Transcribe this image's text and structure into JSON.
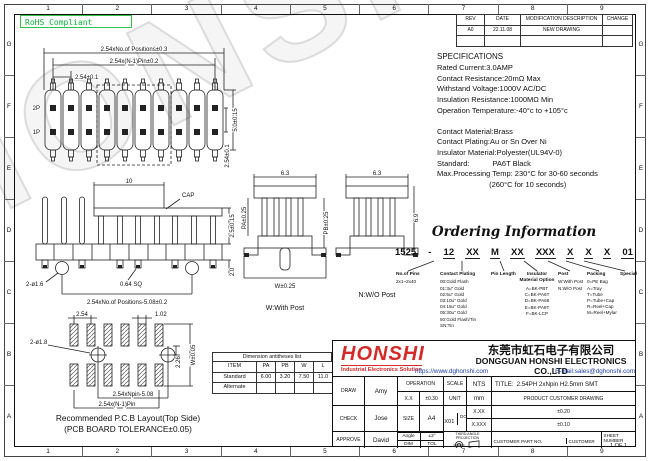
{
  "frame": {
    "cols": [
      "1",
      "2",
      "3",
      "4",
      "5",
      "6",
      "7",
      "8",
      "9"
    ],
    "rows": [
      "G",
      "F",
      "E",
      "D",
      "C",
      "B",
      "A"
    ]
  },
  "rohs_label": "RoHS Compliant",
  "watermark": "HONSHI",
  "colors": {
    "rohs_green": "#0db33a",
    "logo_red": "#d42a28",
    "link_blue": "#1a3aa8",
    "line_black": "#1a1a1a"
  },
  "revision_table": {
    "headers": [
      "REV",
      "DATE",
      "MODIFICATION DESCRIPTION",
      "CHANGE"
    ],
    "rows": [
      [
        "A0",
        "22.11.08",
        "NEW DRAWING",
        ""
      ]
    ]
  },
  "specifications": {
    "title": "SPECIFICATIONS",
    "lines": [
      "Rated Current:3.0AMP",
      "Contact Resistance:20mΩ Max",
      "Withstand Voltage:1000V AC/DC",
      "Insulation Resistance:1000MΩ Min",
      "Operation Temperature:-40°c to +105°c",
      "",
      "Contact Material:Brass",
      "Contact Plating:Au or Sn Over Ni",
      "Insulator Material:Polyester(UL94V-0)",
      "Standard:           PA6T Black",
      "Max.Processing Temp: 230°C for 30-60 seconds",
      "                         (260°C for 10 seconds)"
    ]
  },
  "ordering": {
    "title": "Ordering Information",
    "segments": [
      "1525",
      "-",
      "12",
      "XX",
      "M",
      "XX",
      "XXX",
      "X",
      "X",
      "X",
      "01"
    ],
    "columns": [
      {
        "label": "No.of Pins",
        "options": [
          "2x1~2x40"
        ]
      },
      {
        "label": "Contact Plating",
        "options": [
          "00:Gold Flash",
          "01:3u\" Gold",
          "02:5u\" Gold",
          "03:10u\" Gold",
          "04:15u\" Gold",
          "05:30u\" Gold",
          "50:Gold Flash/Tin",
          "SN:Tin"
        ]
      },
      {
        "label": "Pin Length",
        "options": []
      },
      {
        "label": "Insulator Material Option",
        "options": [
          "A=BK-PBT",
          "C=BK-PA6T",
          "D=BK-PA66",
          "E=BK-PA9T",
          "F=BK-LCP"
        ]
      },
      {
        "label": "Post",
        "options": [
          "W:With Post",
          "N:W/O Post"
        ]
      },
      {
        "label": "Packing",
        "options": [
          "0=PE Bag",
          "A=Tray",
          "T=Tube",
          "P=Tube+Cap",
          "R=Reel+Cap",
          "M=Reel+Mylar"
        ]
      },
      {
        "label": "Special",
        "options": []
      }
    ]
  },
  "drawings": {
    "top_view": {
      "dim_total": "2.54xNo.of Positions±0.3",
      "dim_pins": "2.54x(N-1)Pin±0.2",
      "dim_pitch": "2.54±0.1",
      "row_top": "2P",
      "row_bottom": "1P",
      "dim_height": "5.0±0.15",
      "dim_row_pitch": "2.54±0.1"
    },
    "front_view": {
      "dim_cap": "10",
      "cap_label": "CAP",
      "dim_pin_top": "2.5±0.15",
      "dim_posts": "2-ø1.6",
      "dim_pin_sq": "0.64 SQ",
      "dim_span": "2.54xNo.of Positions-5.08±0.2",
      "dim_post_h": "2.0"
    },
    "side_views": {
      "dim_width_w": "6.3",
      "dim_pa": "PA±0.25",
      "dim_pb": "PB±0.25",
      "dim_w": "W±0.25",
      "caption_w": "W:With Post",
      "dim_width_n": "6.3",
      "dim_h_n": "6.9",
      "caption_n": "N:W/O Post"
    },
    "pcb": {
      "dim_pitch": "2.54",
      "dim_pad_w": "1.02",
      "dim_holes": "2-ø1.8",
      "dim_2_26": "2.26",
      "dim_w": "W±0.05",
      "dim_npin": "2.54xNpin-5.08",
      "dim_n1pin": "2.54x(N-1)Pin",
      "caption1": "Recommended P.C.B Layout(Top Side)",
      "caption2": "(PCB BOARD TOLERANCE±0.05)"
    }
  },
  "dimension_table": {
    "title": "Dimension antitheses list",
    "headers": [
      "ITEM",
      "PA",
      "PB",
      "W",
      "L"
    ],
    "rows": [
      [
        "Standard",
        "6.00",
        "3.20",
        "7.50",
        "11.0"
      ],
      [
        "Alternate",
        "",
        "",
        "",
        ""
      ]
    ]
  },
  "company": {
    "logo": "HONSHI",
    "tagline": "Industrial Electronics Solution",
    "name_cn": "东莞市虹石电子有限公司",
    "name_en": "DONGGUAN HONSHI ELECTRONICS CO.,LTD",
    "website": "https://www.dghonshi.com",
    "email": "E-mail:sales@dghonshi.com"
  },
  "title_block": {
    "draw_label": "DRAW",
    "draw_name": "Amy",
    "check_label": "CHECK",
    "check_name": "Jose",
    "approve_label": "APPROVE",
    "approve_name": "David",
    "operation_label": "OPERATION",
    "tol1_label": "X.X",
    "tol1": "±0.30",
    "tol2_label": "X.XX",
    "tol2": "±0.20",
    "tol3_label": "X.XXX",
    "tol3": "±0.10",
    "angle_label": "Angle",
    "angle": "±3°",
    "dim_label": "DIM",
    "tol_label": "TOL",
    "scale_label": "SCALE",
    "scale": "NTS",
    "unit_label": "UNIT",
    "unit": "mm",
    "size_label": "SIZE",
    "size": "A4",
    "projection_label": "THIRD ANGLE PROJECTION",
    "title_label": "TITLE:",
    "title": "2.54PH 2xNpin H2.5mm SMT",
    "product": "PRODUCT CUSTOMER DRAWING",
    "part_no_label": "PART NO.",
    "part_no": "1525-12XXMXXXXXXXX01",
    "doc_part_label": "DOC PART",
    "doc_part": "001",
    "revision_label": "REVISION",
    "revision": "A0",
    "customer_part_label": "CUSTOMER PART NO.",
    "customer_label": "CUSTOMER",
    "sheet_label": "SHEET NUMBER",
    "sheet": "1 OF 1"
  }
}
